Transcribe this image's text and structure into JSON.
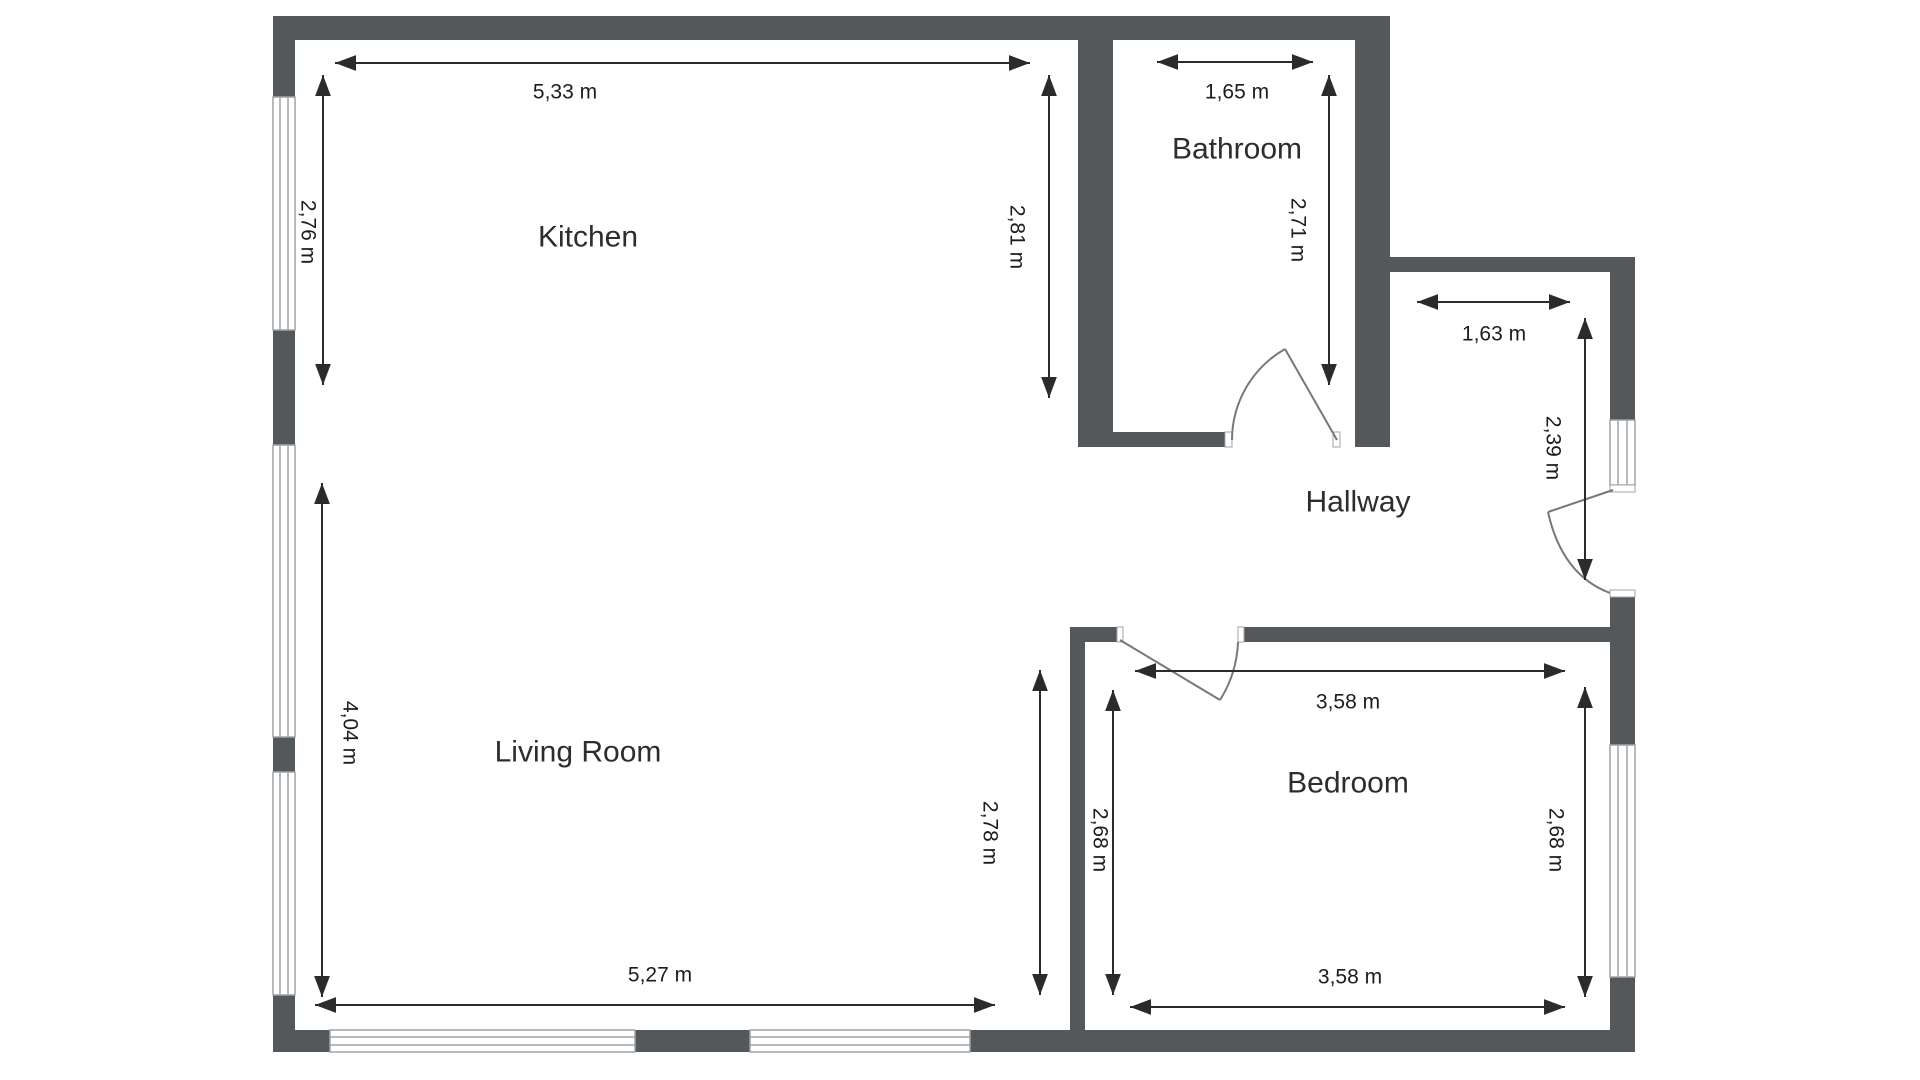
{
  "plan": {
    "type": "apartment-floor-plan",
    "units": "m",
    "background": "#ffffff"
  },
  "rooms": {
    "kitchen": {
      "label": "Kitchen"
    },
    "bathroom": {
      "label": "Bathroom"
    },
    "hallway": {
      "label": "Hallway"
    },
    "living_room": {
      "label": "Living Room"
    },
    "bedroom": {
      "label": "Bedroom"
    }
  },
  "dimensions": {
    "kitchen_width": "5,33 m",
    "kitchen_height_left": "2,76 m",
    "kitchen_height_right": "2,81 m",
    "bathroom_width": "1,65 m",
    "bathroom_height": "2,71 m",
    "hallway_width": "1,63 m",
    "hallway_height": "2,39 m",
    "living_width": "5,27 m",
    "living_height_left": "4,04 m",
    "living_height_right": "2,78 m",
    "bedroom_width_top": "3,58 m",
    "bedroom_width_bottom": "3,58 m",
    "bedroom_height_left": "2,68 m",
    "bedroom_height_right": "2,68 m"
  },
  "colors": {
    "wall": "#54585b",
    "dimension_text": "#1c1c1c",
    "arrow": "#2b2b2b",
    "window_frame": "#9fa4a7",
    "door_line": "#76797b"
  }
}
